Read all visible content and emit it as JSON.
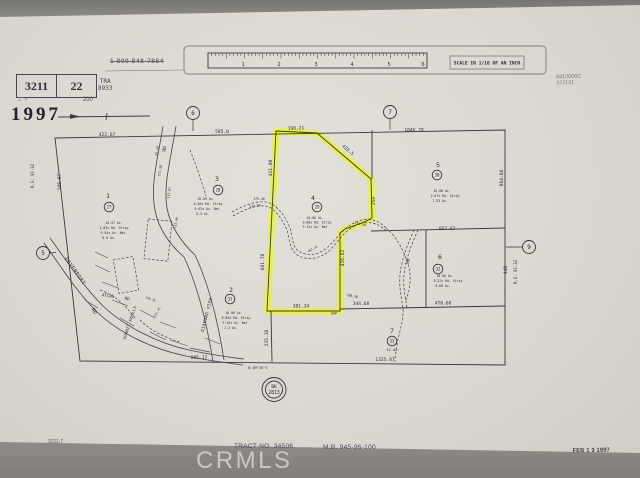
{
  "header": {
    "book": "3211",
    "page": "22",
    "scale_prefix": "1\" =",
    "scale_note": "200'",
    "tra_label": "TRA",
    "tra_value": "8933",
    "year": "1997",
    "phone": "1 800 848-7884",
    "hw1": "8412000C",
    "hw2": "371131"
  },
  "footer": {
    "sheet_no": "3211-7",
    "tract": "TRACT NO. 34506",
    "map_book": "M.B. 945-96-100",
    "date_stamp": "FEB 1 3 1997",
    "watermark": "CRMLS"
  },
  "colors": {
    "highlight": "#e8f23c",
    "ink": "#2e2d33",
    "paper": "#dcd9d2",
    "backdrop": "#8f8d88"
  },
  "map": {
    "bk_circle": {
      "line1": "BK",
      "line2": "2813"
    },
    "circles": [
      {
        "n": "section-number-circle",
        "t": "6",
        "x": 193,
        "y": 113,
        "rad": 6.5,
        "s": 6
      },
      {
        "n": "section-number-circle",
        "t": "7",
        "x": 390,
        "y": 112,
        "rad": 6.5,
        "s": 6
      },
      {
        "n": "section-number-circle",
        "t": "5",
        "x": 43,
        "y": 253,
        "rad": 6.5,
        "s": 6
      },
      {
        "n": "section-number-circle",
        "t": "9",
        "x": 529,
        "y": 247,
        "rad": 6.5,
        "s": 6
      },
      {
        "n": "parcel-apn-circle",
        "t": "27",
        "x": 109,
        "y": 207,
        "rad": 4.8,
        "s": 4
      },
      {
        "n": "parcel-apn-circle",
        "t": "28",
        "x": 218,
        "y": 190,
        "rad": 4.8,
        "s": 4
      },
      {
        "n": "parcel-apn-circle",
        "t": "29",
        "x": 317,
        "y": 207,
        "rad": 4.8,
        "s": 4
      },
      {
        "n": "parcel-apn-circle",
        "t": "30",
        "x": 437,
        "y": 175,
        "rad": 4.8,
        "s": 4
      },
      {
        "n": "parcel-apn-circle",
        "t": "31",
        "x": 230,
        "y": 299,
        "rad": 4.8,
        "s": 4
      },
      {
        "n": "parcel-apn-circle",
        "t": "32",
        "x": 438,
        "y": 269,
        "rad": 4.8,
        "s": 4
      },
      {
        "n": "parcel-apn-circle",
        "t": "33",
        "x": 392,
        "y": 341,
        "rad": 4.8,
        "s": 4
      }
    ],
    "labels": [
      {
        "n": "ruler-number",
        "t": "1",
        "x": 243,
        "y": 66,
        "s": 5.2
      },
      {
        "n": "ruler-number",
        "t": "2",
        "x": 279,
        "y": 66,
        "s": 5.2
      },
      {
        "n": "ruler-number",
        "t": "3",
        "x": 316,
        "y": 66,
        "s": 5.2
      },
      {
        "n": "ruler-number",
        "t": "4",
        "x": 352,
        "y": 66,
        "s": 5.2
      },
      {
        "n": "ruler-number",
        "t": "5",
        "x": 389,
        "y": 66,
        "s": 5.2
      },
      {
        "n": "ruler-number",
        "t": "6",
        "x": 423,
        "y": 66,
        "s": 5.2
      },
      {
        "n": "scale-caption",
        "t": "SCALE IN 1/10 OF AN INCH",
        "x": 487,
        "y": 64.5,
        "s": 4.6,
        "b": 1
      },
      {
        "n": "dimension-label",
        "t": "422.67",
        "x": 107,
        "y": 136,
        "s": 4.6
      },
      {
        "n": "dimension-label",
        "t": "585.0",
        "x": 222,
        "y": 133,
        "s": 4.6
      },
      {
        "n": "dimension-label",
        "t": "198.21",
        "x": 296,
        "y": 129.5,
        "s": 4.6,
        "r": -2
      },
      {
        "n": "dimension-label",
        "t": "433.5",
        "x": 347,
        "y": 151,
        "s": 4.6,
        "r": 40
      },
      {
        "n": "dimension-label",
        "t": "1046.79",
        "x": 414,
        "y": 131.5,
        "s": 4.6
      },
      {
        "n": "dimension-label",
        "t": "108.67",
        "x": 61,
        "y": 182,
        "s": 4.6,
        "r": -90
      },
      {
        "n": "dimension-label",
        "t": "411.98",
        "x": 272,
        "y": 168,
        "s": 4.6,
        "r": -90
      },
      {
        "n": "dimension-label",
        "t": "601.78",
        "x": 264,
        "y": 262,
        "s": 4.6,
        "r": -90
      },
      {
        "n": "dimension-label",
        "t": "250",
        "x": 375,
        "y": 201,
        "s": 4.6,
        "r": -90
      },
      {
        "n": "dimension-label",
        "t": "456.62",
        "x": 344,
        "y": 258,
        "s": 4.6,
        "r": -90
      },
      {
        "n": "dimension-label",
        "t": "864.68",
        "x": 503,
        "y": 178,
        "s": 4.6,
        "r": -90
      },
      {
        "n": "dimension-label",
        "t": "667.67",
        "x": 447,
        "y": 230,
        "s": 4.6
      },
      {
        "n": "dimension-label",
        "t": "448",
        "x": 507,
        "y": 270,
        "s": 4.6,
        "r": -90
      },
      {
        "n": "dimension-label",
        "t": "344.68",
        "x": 361,
        "y": 305,
        "s": 4.6
      },
      {
        "n": "dimension-label",
        "t": "381.34",
        "x": 301,
        "y": 307.5,
        "s": 4.6
      },
      {
        "n": "gap-note",
        "t": "GAP",
        "x": 334,
        "y": 314.5,
        "s": 3.6
      },
      {
        "n": "dimension-label",
        "t": "478.68",
        "x": 443,
        "y": 304.5,
        "s": 4.6
      },
      {
        "n": "dimension-label",
        "t": "235.18",
        "x": 268,
        "y": 338,
        "s": 4.6,
        "r": -90
      },
      {
        "n": "dimension-label",
        "t": "885.17",
        "x": 199,
        "y": 359,
        "s": 4.6
      },
      {
        "n": "dimension-label",
        "t": "1325.87",
        "x": 385,
        "y": 361,
        "s": 4.6
      },
      {
        "n": "bearing-note",
        "t": "N 89°45'E",
        "x": 258,
        "y": 369,
        "s": 3.6
      },
      {
        "n": "dimension-label",
        "t": "131.38",
        "x": 161,
        "y": 171,
        "s": 3.2,
        "r": -80
      },
      {
        "n": "dimension-label",
        "t": "133.87",
        "x": 170,
        "y": 193,
        "s": 3.2,
        "r": -80
      },
      {
        "n": "dimension-label",
        "t": "45.10",
        "x": 158,
        "y": 151,
        "s": 3.2,
        "r": -80
      },
      {
        "n": "dimension-label",
        "t": "132.40",
        "x": 177,
        "y": 223,
        "s": 3.2,
        "r": -78
      },
      {
        "n": "dimension-label",
        "t": "179.46",
        "x": 259,
        "y": 200,
        "s": 3.2
      },
      {
        "n": "dimension-label",
        "t": "132.50",
        "x": 255,
        "y": 207,
        "s": 3.2,
        "r": -8
      },
      {
        "n": "dimension-label",
        "t": "254.38",
        "x": 360,
        "y": 225,
        "s": 3.2,
        "r": 12
      },
      {
        "n": "dimension-label",
        "t": "162.45",
        "x": 313,
        "y": 250,
        "s": 3,
        "r": -28
      },
      {
        "n": "dimension-label",
        "t": "298.38",
        "x": 352,
        "y": 297,
        "s": 3.2,
        "r": 10
      },
      {
        "n": "dimension-label",
        "t": "213.75",
        "x": 158,
        "y": 313,
        "s": 3,
        "r": -60
      },
      {
        "n": "dimension-label",
        "t": "130.35",
        "x": 150,
        "y": 300,
        "s": 3,
        "r": 20
      },
      {
        "n": "parcel-number",
        "t": "1",
        "x": 108,
        "y": 198,
        "s": 6.5
      },
      {
        "n": "parcel-number",
        "t": "2",
        "x": 231,
        "y": 292,
        "s": 6.5
      },
      {
        "n": "parcel-number",
        "t": "3",
        "x": 217,
        "y": 181,
        "s": 6.5
      },
      {
        "n": "parcel-number",
        "t": "4",
        "x": 313,
        "y": 200,
        "s": 6.5
      },
      {
        "n": "parcel-number",
        "t": "5",
        "x": 438,
        "y": 167,
        "s": 6.5
      },
      {
        "n": "parcel-number",
        "t": "6",
        "x": 440,
        "y": 259,
        "s": 6.5
      },
      {
        "n": "parcel-number",
        "t": "7",
        "x": 392,
        "y": 333,
        "s": 6.5
      },
      {
        "n": "acreage-note",
        "t": "10.57 Ac.",
        "x": 114,
        "y": 224,
        "s": 3.2
      },
      {
        "n": "acreage-note",
        "t": "1.03± Rd. Strip",
        "x": 114,
        "y": 229,
        "s": 3.2
      },
      {
        "n": "acreage-note",
        "t": "9.54± Ac. Net",
        "x": 113,
        "y": 234,
        "s": 3.2
      },
      {
        "n": "acreage-note",
        "t": "8.9 Ac.",
        "x": 109,
        "y": 239,
        "s": 3.2
      },
      {
        "n": "acreage-note",
        "t": "10.03 Ac.",
        "x": 206,
        "y": 200,
        "s": 3.2
      },
      {
        "n": "acreage-note",
        "t": "0.40± Rd. Strip",
        "x": 208,
        "y": 205,
        "s": 3.2
      },
      {
        "n": "acreage-note",
        "t": "9.63± Ac. Net",
        "x": 207,
        "y": 210,
        "s": 3.2
      },
      {
        "n": "acreage-note",
        "t": "8.3 Ac.",
        "x": 203,
        "y": 215,
        "s": 3.2
      },
      {
        "n": "acreage-note",
        "t": "10.00 Ac.",
        "x": 315,
        "y": 219,
        "s": 3.2
      },
      {
        "n": "acreage-note",
        "t": "0.88± Rd. Strip",
        "x": 317,
        "y": 223.5,
        "s": 3.2
      },
      {
        "n": "acreage-note",
        "t": "9.12± Ac. Net",
        "x": 315,
        "y": 228,
        "s": 3.2
      },
      {
        "n": "acreage-note",
        "t": "10.00 Ac.",
        "x": 442,
        "y": 192,
        "s": 3.2
      },
      {
        "n": "acreage-note",
        "t": "2.67± Rd. Strip",
        "x": 445,
        "y": 197,
        "s": 3.2
      },
      {
        "n": "acreage-note",
        "t": "7.33 Ac.",
        "x": 440,
        "y": 202,
        "s": 3.2
      },
      {
        "n": "acreage-note",
        "t": "10.00 Ac.",
        "x": 445,
        "y": 277,
        "s": 3.2
      },
      {
        "n": "acreage-note",
        "t": "0.32± Rd. Strip",
        "x": 448,
        "y": 282,
        "s": 3.2
      },
      {
        "n": "acreage-note",
        "t": "9.68 Ac.",
        "x": 443,
        "y": 287,
        "s": 3.2
      },
      {
        "n": "acreage-note",
        "t": "10.98 Ac.",
        "x": 234,
        "y": 314,
        "s": 3.2
      },
      {
        "n": "acreage-note",
        "t": "0.80± Rd. Strip",
        "x": 236,
        "y": 319,
        "s": 3.2
      },
      {
        "n": "acreage-note",
        "t": "9.20± Ac. Net",
        "x": 235,
        "y": 324,
        "s": 3.2
      },
      {
        "n": "acreage-note",
        "t": "2.2 Ac.",
        "x": 231,
        "y": 329,
        "s": 3.2
      },
      {
        "n": "acreage-note",
        "t": "12 Ac.",
        "x": 393,
        "y": 351,
        "s": 3.6
      },
      {
        "n": "road-name",
        "t": "DAVENPORT",
        "x": 74,
        "y": 272,
        "s": 5,
        "r": 55,
        "ls": 0.6
      },
      {
        "n": "road-name",
        "t": "RD",
        "x": 93,
        "y": 312,
        "s": 5,
        "r": 55
      },
      {
        "n": "road-name",
        "t": "ATLAS",
        "x": 108,
        "y": 297,
        "s": 4.2,
        "r": 8
      },
      {
        "n": "road-name",
        "t": "RD",
        "x": 127,
        "y": 300,
        "s": 4.2,
        "r": 8
      },
      {
        "n": "road-name",
        "t": "SUMMIT KNOLLS",
        "x": 131,
        "y": 323,
        "s": 4,
        "r": -72,
        "ls": 0.3
      },
      {
        "n": "road-name",
        "t": "DIAMOND VIEW",
        "x": 208,
        "y": 315,
        "s": 4.2,
        "r": -76,
        "ls": 0.4
      },
      {
        "n": "road-name",
        "t": "RD",
        "x": 166,
        "y": 149,
        "s": 4.6,
        "r": -85
      },
      {
        "n": "road-name",
        "t": "LN",
        "x": 409,
        "y": 262,
        "s": 4.6,
        "r": -72
      },
      {
        "n": "survey-ref",
        "t": "R.S. 91-32",
        "x": 34,
        "y": 176,
        "s": 4,
        "r": -90
      },
      {
        "n": "survey-ref",
        "t": "R.S. 91-32",
        "x": 517,
        "y": 272,
        "s": 4,
        "r": -90
      },
      {
        "n": "bk-circle-line1",
        "t": "BK",
        "x": 274,
        "y": 388,
        "s": 4.4
      },
      {
        "n": "bk-circle-line2",
        "t": "2813",
        "x": 274,
        "y": 394,
        "s": 4.8
      }
    ]
  }
}
